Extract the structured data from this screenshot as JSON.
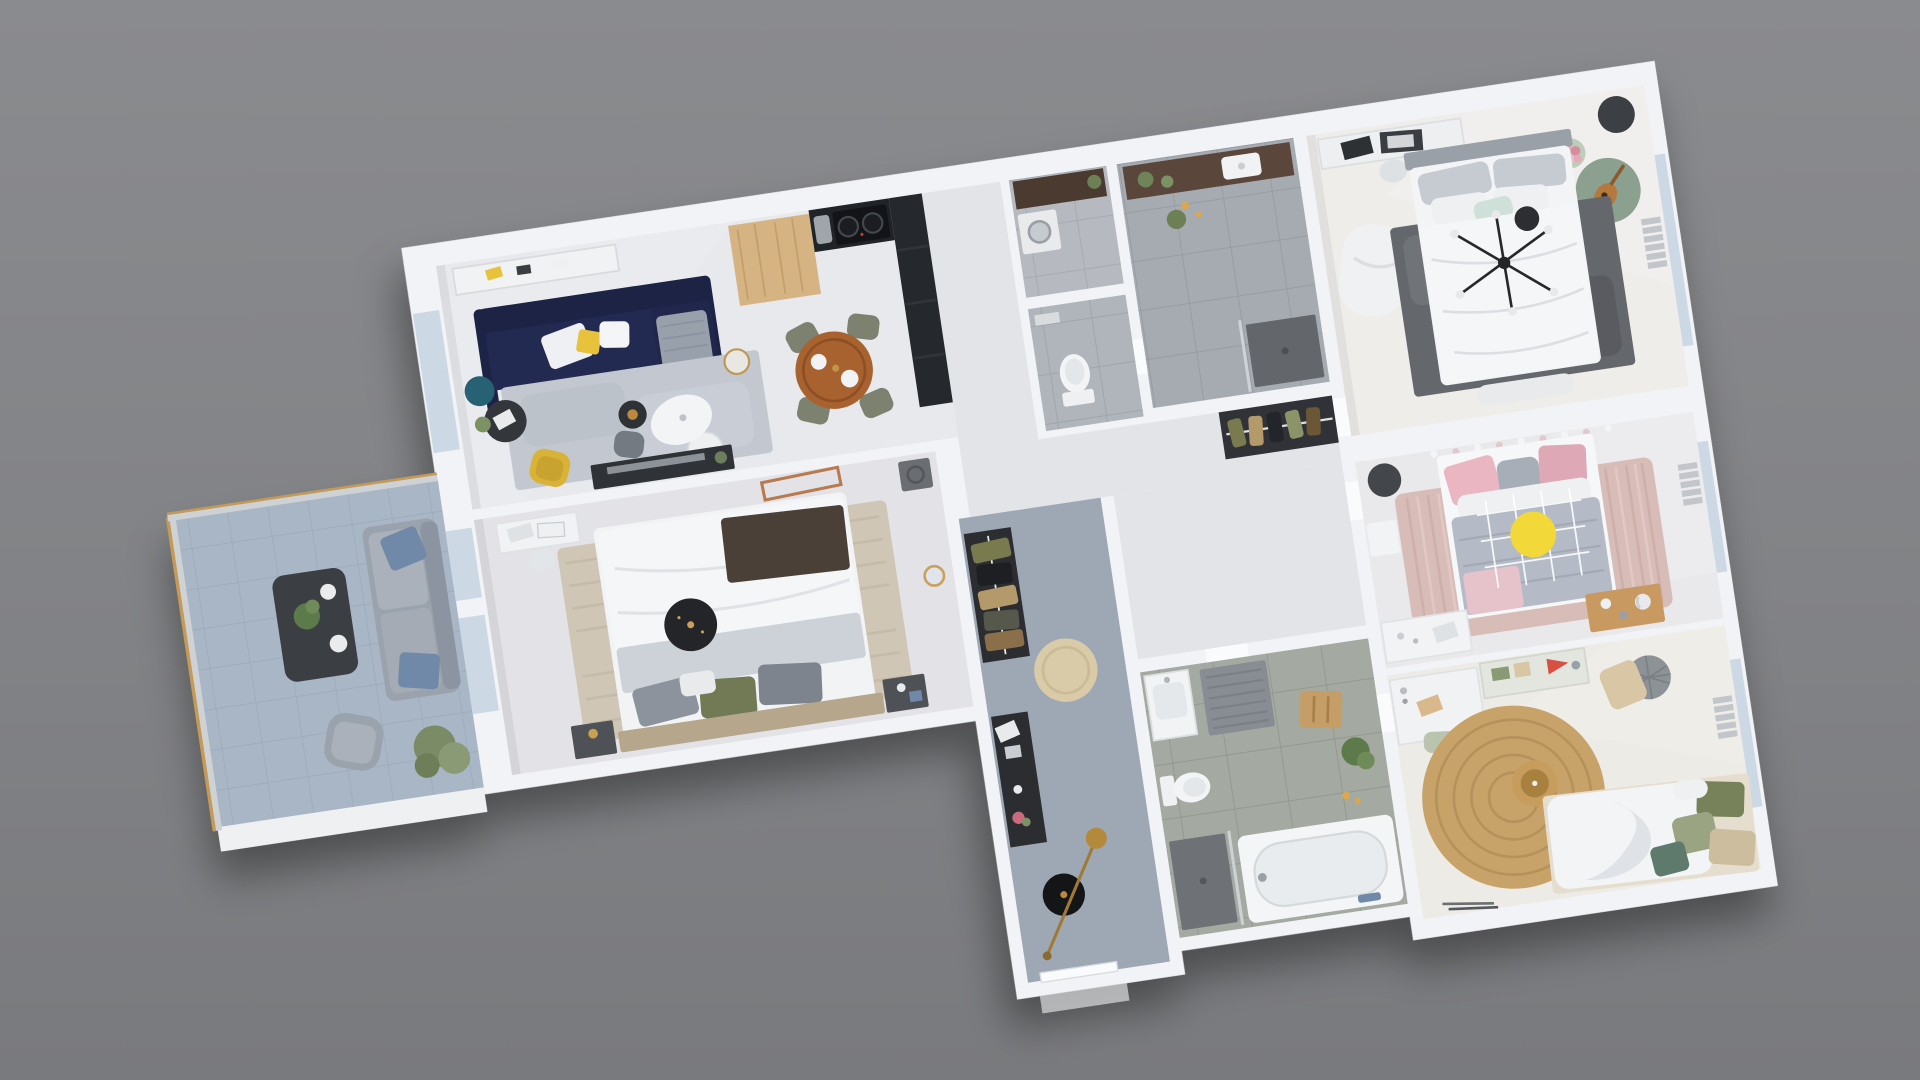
{
  "scene": {
    "type": "3d-floor-plan-render",
    "view": "overhead top-down 3D render of a furnished apartment",
    "rotation_deg": -8.5,
    "background_top": "#8a8b8e",
    "background_bottom": "#797a7d",
    "wall_color": "#f2f3f6",
    "shadow_color": "#000000"
  },
  "key_colors": {
    "sofa_navy": "#1d2344",
    "kitchen_counter": "#202328",
    "kitchen_block": "#d6b383",
    "dining_table": "#a8622f",
    "living_rug": "#c3c8d0",
    "master_rug": "#64676c",
    "pink_rug": "#d8bcb8",
    "jute_rug": "#c8a369",
    "bed2_rug": "#cfc6b6",
    "yellow_disc": "#f2d838",
    "yellow_chair": "#d9b238",
    "wardrobe_dark": "#2b2d31",
    "tub_white": "#f3f5f6",
    "glass_window": "#ccd9e4",
    "balcony_rail_cap": "#c49a58",
    "chandelier_black": "#26282a",
    "entry_rug": "#d9cba8",
    "olive_chair": "#7d8170"
  },
  "rooms": [
    {
      "id": "living-dining",
      "name": "Open living / dining / kitchen",
      "floor": "#e7e9ec",
      "furniture": [
        "navy L-sofa with white and yellow cushions",
        "gray area rug",
        "white organic floor lamp",
        "teal side table",
        "black side table with tablet",
        "white round coffee table",
        "dark round coffee table",
        "gray pouf",
        "yellow armchair",
        "white sideboard with decor",
        "dark TV console with TV",
        "gold glass side table",
        "oak kitchen block",
        "black kitchen counter with hob and sink",
        "tall dark kitchen units",
        "round wooden dining table",
        "four olive dining chairs"
      ]
    },
    {
      "id": "corridor",
      "name": "Corridor / hall",
      "floor": "#e2e4e7",
      "furniture": [
        "door thresholds"
      ]
    },
    {
      "id": "utility",
      "name": "Utility room",
      "floor": "#b6bac0",
      "furniture": [
        "dark shelf unit",
        "washing machine",
        "green plant"
      ]
    },
    {
      "id": "wc",
      "name": "WC",
      "floor": "#b0b5bb",
      "furniture": [
        "toilet"
      ]
    },
    {
      "id": "bathroom-1",
      "name": "Bathroom 1",
      "floor": "#a6abb1",
      "furniture": [
        "dark wood vanity with basin",
        "plants",
        "candles",
        "walk-in shower with dark tray",
        "glass partition"
      ]
    },
    {
      "id": "master-bedroom",
      "name": "Master bedroom",
      "floor": "#efedea",
      "furniture": [
        "double bed with white duvet and gray pillows",
        "mint cushion",
        "dark mottled rug",
        "black sputnik chandelier",
        "white desk with sketches",
        "white chaise lounge",
        "dark round stool",
        "pink bouquet on plant table",
        "green round rug with guitar",
        "foot bench",
        "radiator",
        "window"
      ]
    },
    {
      "id": "dressing",
      "name": "Dressing closet",
      "floor": "#303237",
      "furniture": [
        "clothes rail with hanging clothes"
      ]
    },
    {
      "id": "bedroom-pink",
      "name": "Bedroom (pink)",
      "floor": "#e9e8ea",
      "furniture": [
        "bed with pink and gray pillows",
        "gray duvet",
        "pom-pom garland",
        "white wire canopy",
        "yellow round cushion",
        "pink textured rug",
        "dark stool",
        "white desk",
        "white wall bench",
        "low wooden table with decor",
        "radiator",
        "window"
      ]
    },
    {
      "id": "bedroom-teen",
      "name": "Bedroom (teen)",
      "floor": "#edebe5",
      "furniture": [
        "round jute rug",
        "rattan pendant lamp",
        "bed with white duvet and olive pillows",
        "white desk with notebook",
        "sage desk chair",
        "wall shelf with red pennant",
        "ribbed gray pouf",
        "beige floor cushion",
        "radiator",
        "window"
      ]
    },
    {
      "id": "bathroom-2",
      "name": "Bathroom 2",
      "floor": "#a4a9a1",
      "furniture": [
        "bathtub",
        "walk-in shower with dark floor",
        "toilet",
        "white vanity basin",
        "gray bath mat",
        "wooden stool",
        "green plant",
        "candles"
      ]
    },
    {
      "id": "entry",
      "name": "Entry hall",
      "floor": "#9ea8b4",
      "furniture": [
        "black open wardrobe with clothes",
        "round beige rug",
        "dark console with frames and flowers",
        "black round stool",
        "brass arc floor lamp",
        "front door"
      ]
    },
    {
      "id": "bedroom-2",
      "name": "Bedroom 2",
      "floor": "#e3e3e7",
      "furniture": [
        "double bed with white duvet, dark brown throw and gray/olive pillows",
        "wood headboard",
        "two dark nightstands with lamps",
        "beige textured rug",
        "black round pendant lamp",
        "white desk with chair",
        "copper light frame",
        "gray speaker",
        "gold wall mirror",
        "balcony doors"
      ]
    },
    {
      "id": "balcony",
      "name": "Balcony / terrace",
      "floor": "#a9b6c6",
      "furniture": [
        "gray outdoor sofa with blue cushions",
        "dark coffee table with plant and plates",
        "gray armchair",
        "green shrub",
        "glass railing with wood cap",
        "white parapet"
      ]
    }
  ]
}
